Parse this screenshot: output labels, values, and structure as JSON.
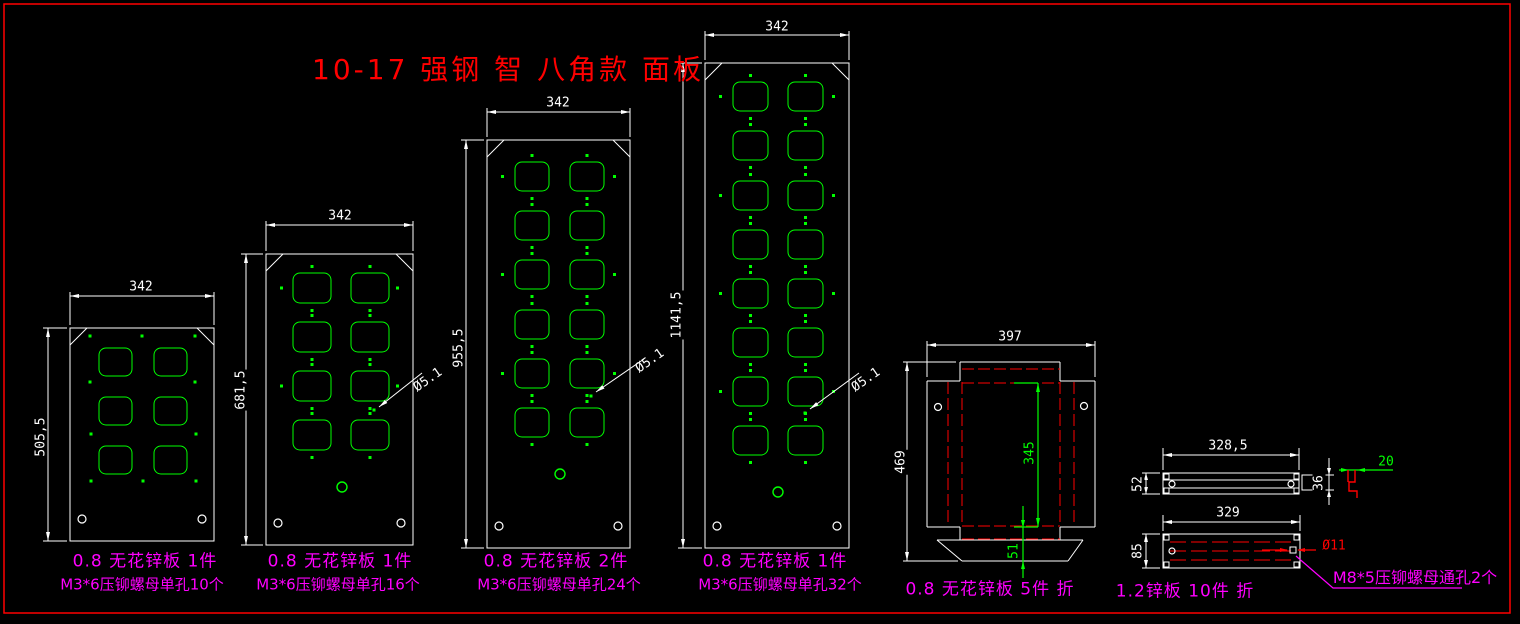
{
  "title": "10-17 强钢 智 八角款 面板",
  "panels": [
    {
      "width_dim": "342",
      "height_dim": "505,5",
      "hole_dim": "",
      "caption_material": "0.8 无花锌板 1件",
      "caption_fastener": "M3*6压铆螺母单孔10个"
    },
    {
      "width_dim": "342",
      "height_dim": "681,5",
      "hole_dim": "Ø5.1",
      "caption_material": "0.8 无花锌板 1件",
      "caption_fastener": "M3*6压铆螺母单孔16个"
    },
    {
      "width_dim": "342",
      "height_dim": "955,5",
      "hole_dim": "Ø5.1",
      "caption_material": "0.8 无花锌板 2件",
      "caption_fastener": "M3*6压铆螺母单孔24个"
    },
    {
      "width_dim": "342",
      "height_dim": "1141,5",
      "hole_dim": "Ø5.1",
      "caption_material": "0.8 无花锌板 1件",
      "caption_fastener": "M3*6压铆螺母单孔32个"
    }
  ],
  "tray": {
    "width_dim": "397",
    "height_dim": "469",
    "opening_height_dim": "345",
    "flap_height_dim": "51",
    "caption": "0.8 无花锌板 5件 折"
  },
  "bars": {
    "top": {
      "length_dim": "328,5",
      "height_dim": "52",
      "end_height_dim": "36",
      "flange_dim": "20"
    },
    "bottom": {
      "length_dim": "329",
      "height_dim": "85",
      "hole_dim": "Ø11",
      "note": "M8*5压铆螺母通孔2个",
      "caption": "1.2锌板 10件 折"
    }
  },
  "colors": {
    "background": "#000000",
    "outline": "#ffffff",
    "feature": "#00ff00",
    "fold": "#ff0000",
    "label": "#ff00ff",
    "title": "#ff0000"
  }
}
